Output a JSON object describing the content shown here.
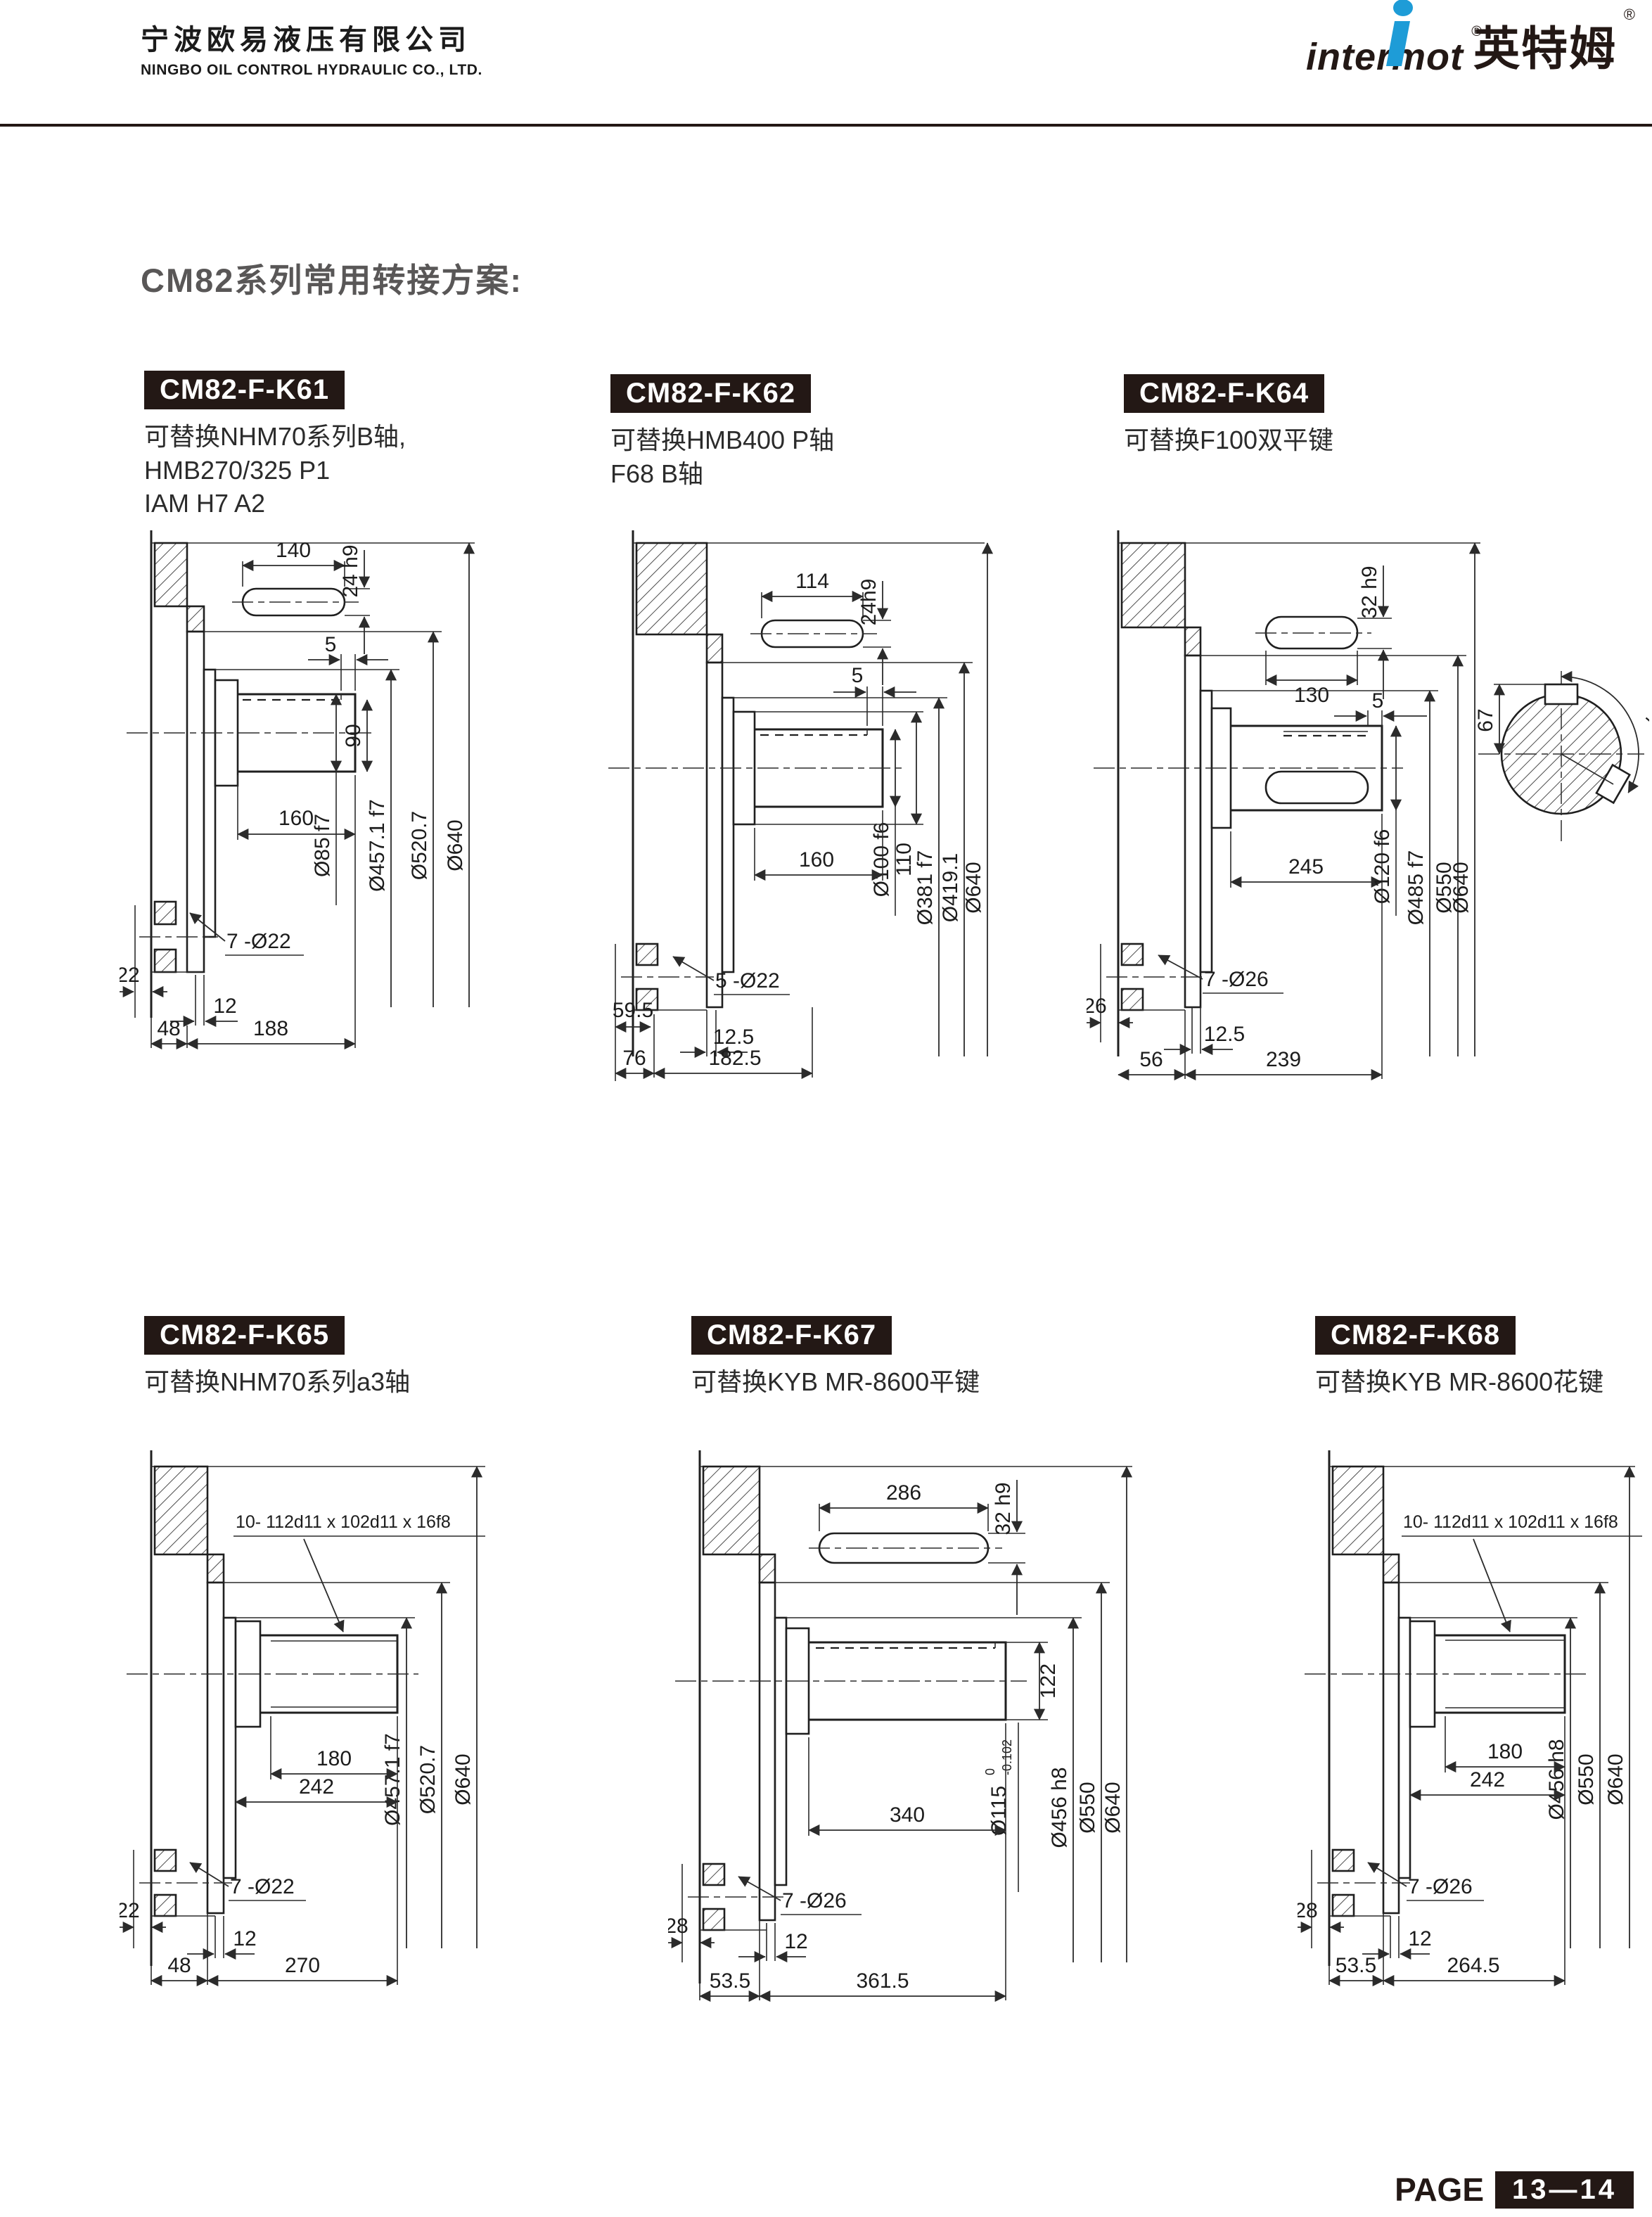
{
  "header": {
    "company_cn": "宁波欧易液压有限公司",
    "company_en": "NINGBO OIL CONTROL HYDRAULIC CO., LTD.",
    "brand_latin": "intermot",
    "brand_cn": "英特姆",
    "reg_mark": "®"
  },
  "section_title": "CM82系列常用转接方案:",
  "footer": {
    "page_label": "PAGE",
    "page_number": "13—14"
  },
  "colors": {
    "brand_blue": "#1e9cd7",
    "badge_bg": "#231815",
    "title_gray": "#595757",
    "line": "#1f1f1f"
  },
  "panels": [
    {
      "badge": "CM82-F-K61",
      "description_lines": [
        "可替换NHM70系列B轴,",
        "HMB270/325 P1",
        "IAM H7 A2"
      ],
      "dims": {
        "key_len": "140",
        "key_h": "24 h9",
        "step": "5",
        "key_depth": "90",
        "shaft_d": "Ø85 f7",
        "pilot_d": "Ø457.1 f7",
        "spigot_d": "Ø520.7",
        "outer_d": "Ø640",
        "shaft_len": "160",
        "holes": "7 -Ø22",
        "flange_offset": "22",
        "hole_offset": "12",
        "flange_w": "48",
        "total_len": "188"
      }
    },
    {
      "badge": "CM82-F-K62",
      "description_lines": [
        "可替换HMB400 P轴",
        "F68 B轴"
      ],
      "dims": {
        "key_len": "114",
        "key_h": "24h9",
        "step": "5",
        "hub_d": "110",
        "shaft_d": "Ø100 f6",
        "pilot_d": "Ø381 f7",
        "spigot_d": "Ø419.1",
        "outer_d": "Ø640",
        "shaft_len": "160",
        "holes": "5 -Ø22",
        "flange_offset": "59.5",
        "hole_offset": "12.5",
        "flange_w": "76",
        "total_len": "182.5"
      }
    },
    {
      "badge": "CM82-F-K64",
      "description_lines": [
        "可替换F100双平键"
      ],
      "dims": {
        "key_len": "130",
        "key_h": "32 h9",
        "step": "5",
        "shaft_d": "Ø120 f6",
        "pilot_d": "Ø485 f7",
        "spigot_d": "Ø550",
        "outer_d": "Ø640",
        "shaft_len": "245",
        "holes": "7 -Ø26",
        "flange_offset": "26",
        "hole_offset": "12.5",
        "flange_w": "56",
        "total_len": "239",
        "end_key_h": "67",
        "end_angle": "120°"
      }
    },
    {
      "badge": "CM82-F-K65",
      "description_lines": [
        "可替换NHM70系列a3轴"
      ],
      "dims": {
        "spline": "10- 112d11 x 102d11 x 16f8",
        "pilot_d": "Ø457.1 f7",
        "spigot_d": "Ø520.7",
        "outer_d": "Ø640",
        "spline_len": "180",
        "shaft_len": "242",
        "holes": "7 -Ø22",
        "flange_offset": "22",
        "hole_offset": "12",
        "flange_w": "48",
        "total_len": "270"
      }
    },
    {
      "badge": "CM82-F-K67",
      "description_lines": [
        "可替换KYB MR-8600平键"
      ],
      "dims": {
        "key_len": "286",
        "key_h": "32 h9",
        "key_depth": "122",
        "shaft_d_main": "Ø115",
        "shaft_d_tol_top": "0",
        "shaft_d_tol_bot": "-0.102",
        "pilot_d": "Ø456 h8",
        "spigot_d": "Ø550",
        "outer_d": "Ø640",
        "shaft_len": "340",
        "holes": "7 -Ø26",
        "flange_offset": "28",
        "hole_offset": "12",
        "flange_w": "53.5",
        "total_len": "361.5"
      }
    },
    {
      "badge": "CM82-F-K68",
      "description_lines": [
        "可替换KYB MR-8600花键"
      ],
      "dims": {
        "spline": "10- 112d11 x 102d11 x 16f8",
        "pilot_d": "Ø456 h8",
        "spigot_d": "Ø550",
        "outer_d": "Ø640",
        "spline_len": "180",
        "shaft_len": "242",
        "holes": "7 -Ø26",
        "flange_offset": "28",
        "hole_offset": "12",
        "flange_w": "53.5",
        "total_len": "264.5"
      }
    }
  ]
}
